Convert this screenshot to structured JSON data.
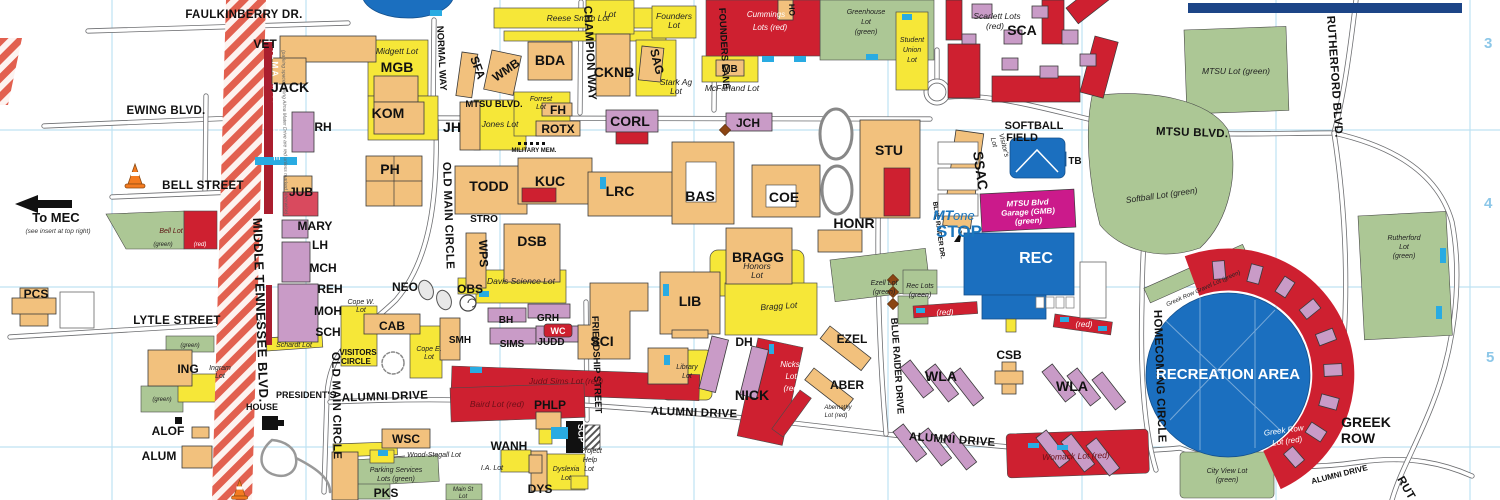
{
  "streets": {
    "faulkinberry": "FAULKINBERRY DR.",
    "ewing": "EWING BLVD.",
    "bell": "BELL STREET",
    "lytle": "LYTLE STREET",
    "middle_tn": "MIDDLE TENNESSEE BLVD.",
    "alma": "ALMA MATER DRIVE",
    "alma_note": "(parking spaces along Alma Mater Drive are red unless marked otherwise)",
    "normal": "NORMAL WAY",
    "mtsu": "MTSU BLVD.",
    "champion": "CHAMPION WAY",
    "founders_ln": "FOUNDERS LANE",
    "old_main": "OLD MAIN CIRCLE",
    "friendship": "FRIENDSHIP STREET",
    "blue_raider": "BLUE RAIDER DRIVE",
    "blue_raider_sm": "BLUE RAIDER DR.",
    "homecoming": "HOMECOMING CIRCLE",
    "rutherford": "RUTHERFORD BLVD.",
    "rutherford_clip": "RUT",
    "alumni": "ALUMNI DRIVE",
    "greek_1": "GREEK",
    "greek_2": "ROW",
    "military": "MILITARY MEM."
  },
  "buildings": {
    "vet": "VET",
    "jack": "JACK",
    "mgb": "MGB",
    "kom": "KOM",
    "rh": "RH",
    "ph": "PH",
    "jub": "JUB",
    "mary": "MARY",
    "lh": "LH",
    "mch": "MCH",
    "reh": "REH",
    "moh": "MOH",
    "sch": "SCH",
    "pcs": "PCS",
    "ing": "ING",
    "alof": "ALOF",
    "alum": "ALUM",
    "wsc": "WSC",
    "pks": "PKS",
    "cab": "CAB",
    "neo": "NEO",
    "obs": "OBS",
    "wps": "WPS",
    "stro": "STRO",
    "dsb": "DSB",
    "smh": "SMH",
    "bh": "BH",
    "grh": "GRH",
    "wc": "WC",
    "sims": "SIMS",
    "judd": "JUDD",
    "sci": "SCI",
    "todd": "TODD",
    "kuc": "KUC",
    "lrc": "LRC",
    "bas": "BAS",
    "coe": "COE",
    "corl": "CORL",
    "jch": "JCH",
    "jh": "JH",
    "fh": "FH",
    "rotx": "ROTX",
    "sfa": "SFA",
    "wmb": "WMB",
    "bda": "BDA",
    "cknb": "CKNB",
    "sag": "SAG",
    "mb": "MB",
    "ho": "HO",
    "stu": "STU",
    "honr": "HONR",
    "bragg": "BRAGG",
    "lib": "LIB",
    "dh": "DH",
    "nick": "NICK",
    "ezel": "EZEL",
    "aber": "ABER",
    "csb": "CSB",
    "wla": "WLA",
    "sca": "SCA",
    "ssac": "SSAC",
    "tb": "TB",
    "rec": "REC",
    "phlp": "PHLP",
    "wanh": "WANH",
    "dys": "DYS",
    "scp": "SCP"
  },
  "lots": {
    "reese": "Reese Smith Lot",
    "midgett": "Midgett Lot",
    "jones": "Jones Lot",
    "forrest_1": "Forrest",
    "forrest_2": "Lot",
    "founders_1": "Founders",
    "founders_2": "Lot",
    "stark_1": "Stark Ag",
    "stark_2": "Lot",
    "mcfarland": "McFarland Lot",
    "cummings_1": "Cummings",
    "cummings_2": "Lots (red)",
    "greenhouse_1": "Greenhouse",
    "greenhouse_2": "Lot",
    "greenhouse_3": "(green)",
    "student_1": "Student",
    "student_2": "Union",
    "student_3": "Lot",
    "scarlett_1": "Scarlett Lots",
    "scarlett_2": "(red)",
    "mtsu_lot": "MTSU Lot (green)",
    "softball_lot": "Softball Lot (green)",
    "visitor_1": "Visitor's",
    "visitor_2": "Lot",
    "garage_1": "MTSU Blvd",
    "garage_2": "Garage (GMB)",
    "garage_3": "(green)",
    "rutherford_1": "Rutherford",
    "rutherford_2": "Lot",
    "rutherford_3": "(green)",
    "ezell_1": "Ezell Lot",
    "ezell_2": "(green)",
    "reclots_1": "Rec Lots",
    "reclots_2": "(green)",
    "honors_1": "Honors",
    "honors_2": "Lot",
    "bragg": "Bragg Lot",
    "davis": "Davis Science Lot",
    "cope_w_1": "Cope W.",
    "cope_w_2": "Lot",
    "cope_e_1": "Cope E.",
    "cope_e_2": "Lot",
    "schardt": "Schardt Lot",
    "library_1": "Library",
    "library_2": "Lot",
    "judd_sims": "Judd Sims Lot (red)",
    "baird": "Baird Lot (red)",
    "nicks_1": "Nicks",
    "nicks_2": "Lot",
    "nicks_3": "(red)",
    "abernathy_1": "Abernathy",
    "abernathy_2": "Lot (red)",
    "womack": "Womack Lot (red)",
    "greekrow_1": "Greek Row",
    "greekrow_2": "Lot (red)",
    "gravel": "Greek Row Gravel Lot (green)",
    "city_1": "City View Lot",
    "city_2": "(green)",
    "ingram_1": "Ingram",
    "ingram_2": "Lot",
    "bell": "Bell Lot",
    "wood": "Wood-Stegall Lot",
    "ia": "I.A. Lot",
    "dyslexia_1": "Dyslexia",
    "dyslexia_2": "Lot",
    "project_1": "Project",
    "project_2": "Help",
    "project_3": "Lot",
    "main_1": "Main St",
    "main_2": "Lot",
    "parking_1": "Parking Services",
    "parking_2": "Lots (green)",
    "partial": "Lot",
    "green": "(green)",
    "red": "(red)"
  },
  "places": {
    "to_mec": "To MEC",
    "to_mec_note": "(see insert at top right)",
    "presidents_1": "PRESIDENT'S",
    "presidents_2": "HOUSE",
    "visitors_1": "VISITORS",
    "visitors_2": "CIRCLE",
    "softball_1": "SOFTBALL",
    "softball_2": "FIELD",
    "rec_area": "RECREATION AREA",
    "mt": "MT",
    "one": "one",
    "stop": "STOP"
  },
  "grid": {
    "n3": "3",
    "n4": "4",
    "n5": "5"
  },
  "colors": {
    "building_tan": "#F2C17D",
    "building_purple": "#C99BC7",
    "building_red": "#CE2030",
    "building_blue": "#1B6FBF",
    "lot_yellow": "#F6E738",
    "lot_green": "#ACC795",
    "lot_red": "#CE2030",
    "garage_magenta": "#CB1A8B",
    "accessible_cyan": "#29ABE2",
    "grid_blue": "#BFE2F2",
    "construction_stripe": "#E2604F",
    "logo_blue": "#1B75BC"
  }
}
